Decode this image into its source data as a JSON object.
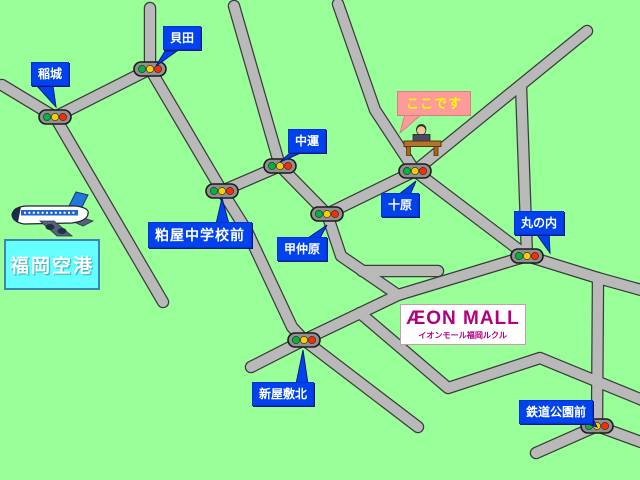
{
  "map_title": "イオンモール福岡ルクル 周辺地図",
  "intersections": {
    "inagi": "稲城",
    "kaida": "貝田",
    "nakaun": "中運",
    "tobaru": "十原",
    "konakabaru": "甲仲原",
    "kasuya_jhs": "粕屋中学校前",
    "marunouchi": "丸の内",
    "shinyashiki_kita": "新屋敷北",
    "tetsudo_koen_mae": "鉄道公園前"
  },
  "landmarks": {
    "destination": {
      "label": "ここです"
    },
    "airport": {
      "label": "福岡空港"
    },
    "aeon": {
      "title": "ÆON MALL",
      "subtitle": "イオンモール福岡ルクル"
    }
  },
  "icons": {
    "traffic_signal": "traffic-signal-icon",
    "airplane": "airplane-icon",
    "reception_desk": "reception-desk-icon"
  },
  "colors": {
    "background": "#99ff99",
    "road_fill": "#b9b9b9",
    "road_outline": "#3c3c3c",
    "label_blue": "#0043ee",
    "here_box": "#ff9a9a",
    "here_text": "#ffff00",
    "airport_box": "#66ffff",
    "airport_text": "#ffffff",
    "aeon_magenta": "#b0007f",
    "signal_green": "#00b53c",
    "signal_yellow": "#ffcc00",
    "signal_red": "#ff2a00"
  }
}
